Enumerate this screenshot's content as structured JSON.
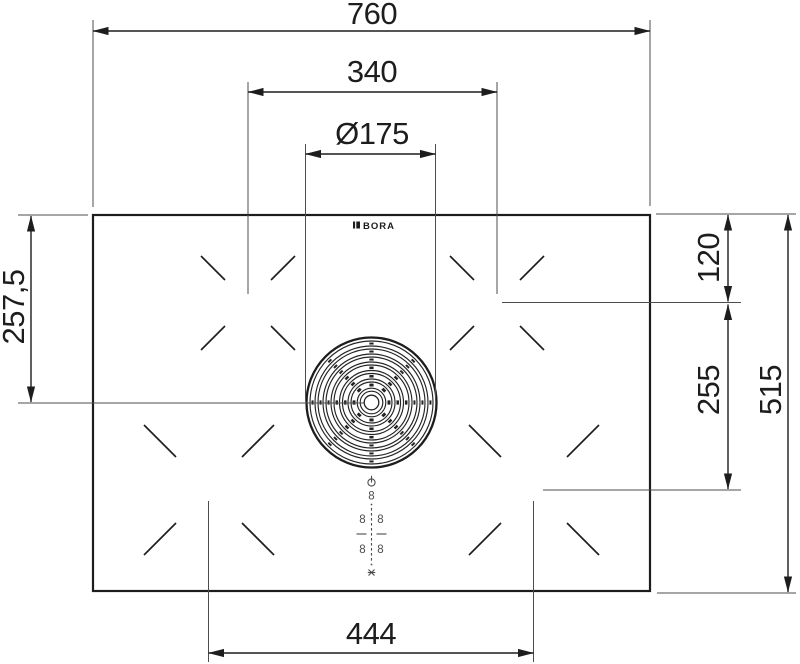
{
  "page": {
    "background": "#ffffff",
    "line_color": "#1d1d1d",
    "drawing_type": "cooktop-dimension-drawing"
  },
  "brand": {
    "logo_text": "BORA"
  },
  "dimensions": {
    "total_width": "760",
    "rear_zone_spacing": "340",
    "extractor_diameter": "Ø175",
    "top_edge_to_extractor_center": "257,5",
    "top_edge_to_rear_zone_center": "120",
    "rear_to_front_zone_center": "255",
    "total_depth": "515",
    "front_zone_spacing": "444"
  },
  "control_panel": {
    "power_icon": "power-symbol",
    "extractor_level_display": "8",
    "zone_displays": [
      "8",
      "8",
      "8",
      "8"
    ],
    "child_lock_icon": "child-lock-symbol"
  }
}
